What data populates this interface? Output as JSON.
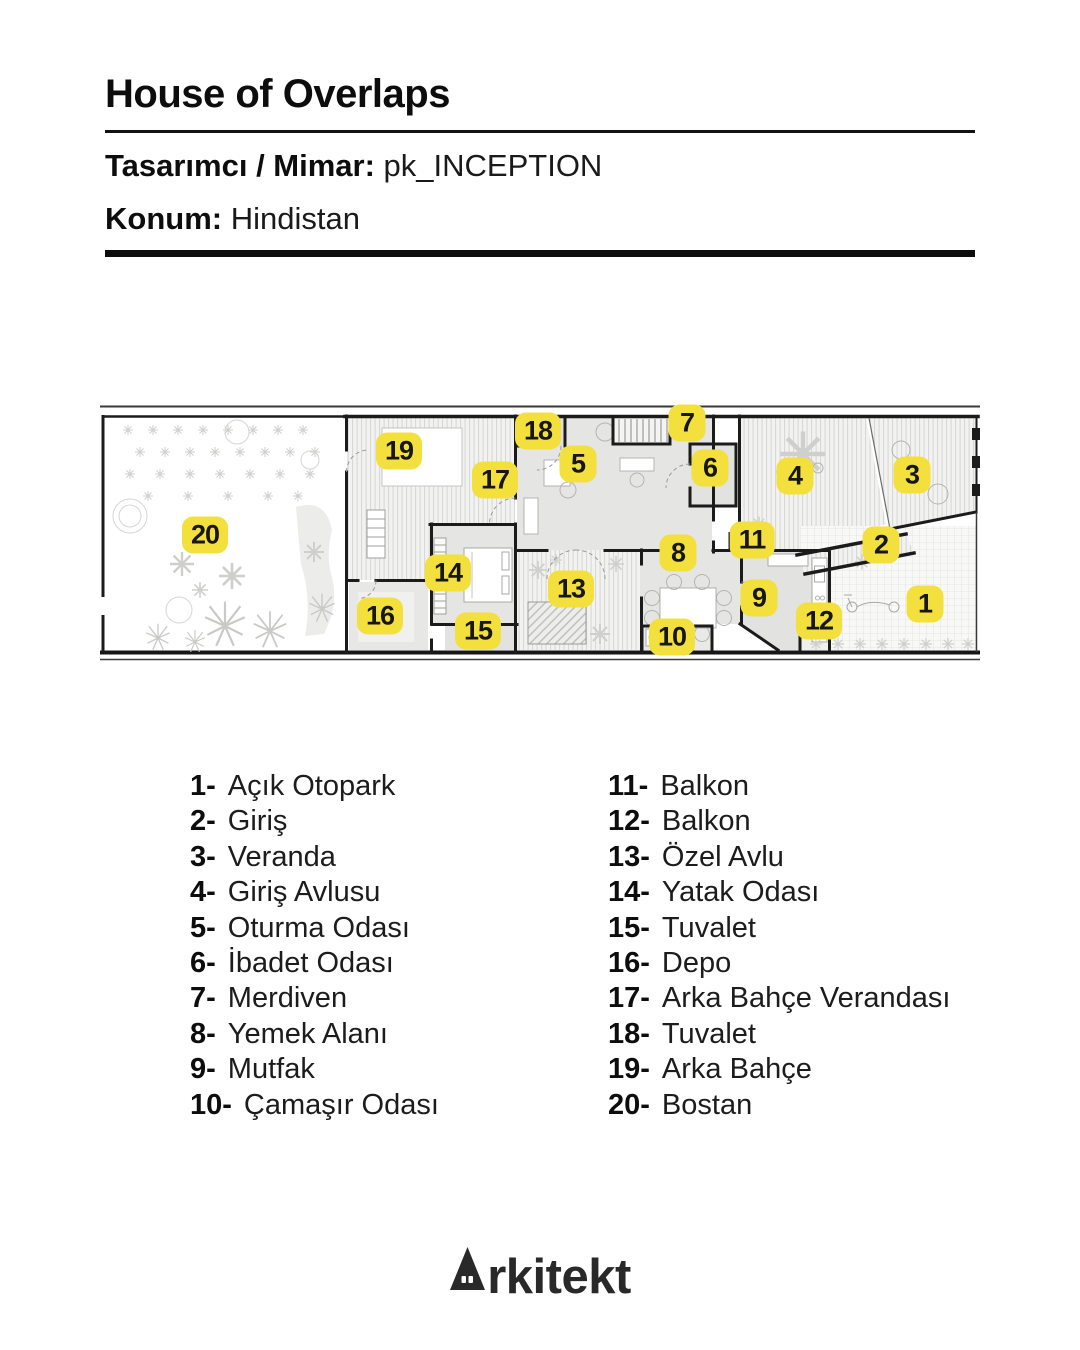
{
  "header": {
    "title": "House of Overlaps",
    "designer_label": "Tasarımcı / Mimar:",
    "designer_value": "pk_INCEPTION",
    "location_label": "Konum:",
    "location_value": "Hindistan"
  },
  "plan": {
    "label_bg_color": "#F3E03C",
    "label_text_color": "#161616",
    "labels": [
      {
        "n": "1",
        "x": 825,
        "y": 202
      },
      {
        "n": "2",
        "x": 781,
        "y": 143
      },
      {
        "n": "3",
        "x": 812,
        "y": 73
      },
      {
        "n": "4",
        "x": 695,
        "y": 74
      },
      {
        "n": "5",
        "x": 478,
        "y": 62
      },
      {
        "n": "6",
        "x": 610,
        "y": 66
      },
      {
        "n": "7",
        "x": 587,
        "y": 21
      },
      {
        "n": "8",
        "x": 578,
        "y": 151
      },
      {
        "n": "9",
        "x": 659,
        "y": 196
      },
      {
        "n": "10",
        "x": 572,
        "y": 235
      },
      {
        "n": "11",
        "x": 652,
        "y": 138
      },
      {
        "n": "12",
        "x": 719,
        "y": 219
      },
      {
        "n": "13",
        "x": 471,
        "y": 187
      },
      {
        "n": "14",
        "x": 348,
        "y": 171
      },
      {
        "n": "15",
        "x": 378,
        "y": 229
      },
      {
        "n": "16",
        "x": 280,
        "y": 214
      },
      {
        "n": "17",
        "x": 395,
        "y": 78
      },
      {
        "n": "18",
        "x": 438,
        "y": 29
      },
      {
        "n": "19",
        "x": 299,
        "y": 49
      },
      {
        "n": "20",
        "x": 105,
        "y": 133
      }
    ]
  },
  "legend": {
    "columns": [
      {
        "items": [
          {
            "n": "1",
            "label": "Açık Otopark"
          },
          {
            "n": "2",
            "label": "Giriş"
          },
          {
            "n": "3",
            "label": "Veranda"
          },
          {
            "n": "4",
            "label": "Giriş Avlusu"
          },
          {
            "n": "5",
            "label": "Oturma Odası"
          },
          {
            "n": "6",
            "label": "İbadet Odası"
          },
          {
            "n": "7",
            "label": "Merdiven"
          },
          {
            "n": "8",
            "label": "Yemek Alanı"
          },
          {
            "n": "9",
            "label": "Mutfak"
          },
          {
            "n": "10",
            "label": "Çamaşır Odası"
          }
        ]
      },
      {
        "items": [
          {
            "n": "11",
            "label": "Balkon"
          },
          {
            "n": "12",
            "label": "Balkon"
          },
          {
            "n": "13",
            "label": "Özel Avlu"
          },
          {
            "n": "14",
            "label": "Yatak Odası"
          },
          {
            "n": "15",
            "label": "Tuvalet"
          },
          {
            "n": "16",
            "label": "Depo"
          },
          {
            "n": "17",
            "label": "Arka Bahçe Verandası"
          },
          {
            "n": "18",
            "label": "Tuvalet"
          },
          {
            "n": "19",
            "label": "Arka Bahçe"
          },
          {
            "n": "20",
            "label": "Bostan"
          }
        ]
      }
    ]
  },
  "footer": {
    "brand": "Arkitekt",
    "brand_rest": "rkitekt"
  }
}
